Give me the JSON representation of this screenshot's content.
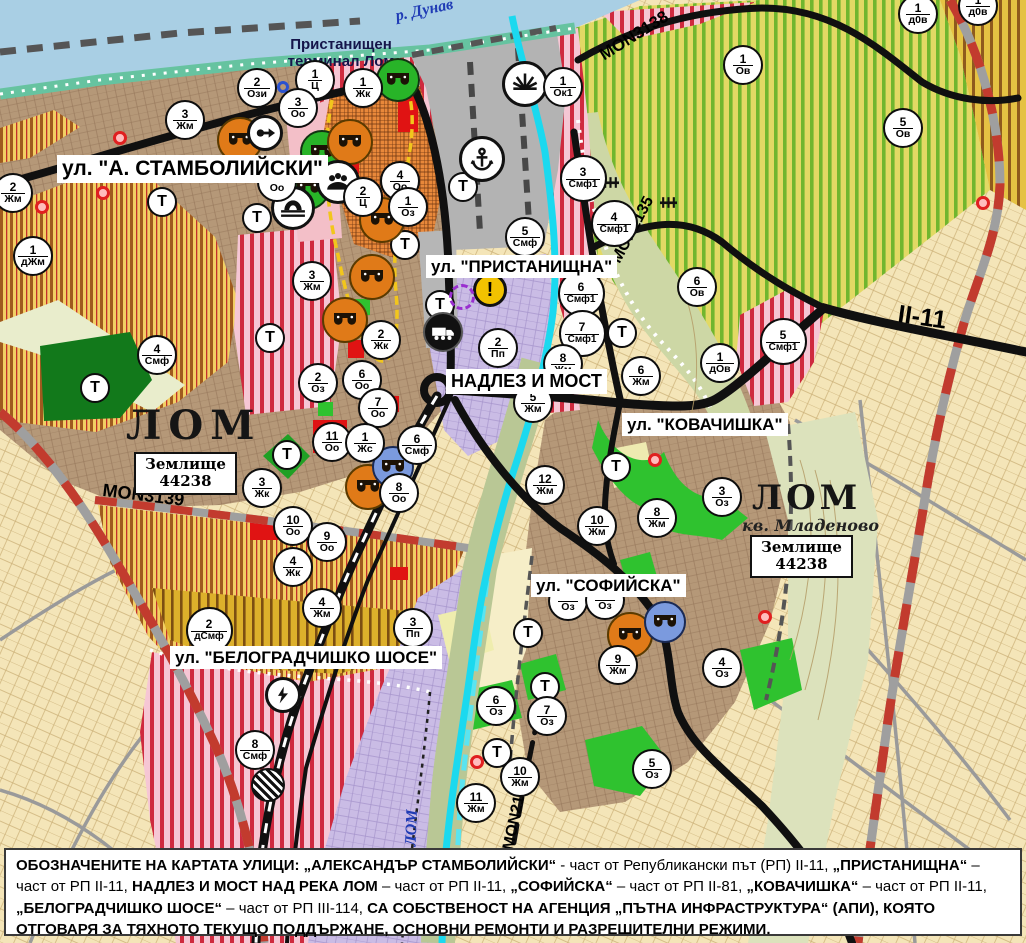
{
  "palette": {
    "water": "#a9cfe4",
    "river_lom": "#1bd9ef",
    "road_black": "#101010",
    "rail_red_dash": "#c23b2e",
    "smf_stripe": "#cf2a3e",
    "villa_stripe": "#70b62e",
    "urban_brown": "#b59878",
    "accent_orange": "#e8883a"
  },
  "water": {
    "danube_label": "р. Дунав",
    "lom_label": "р. ЛОМ"
  },
  "port": {
    "line1": "Пристанищен",
    "line2": "терминал Лом"
  },
  "places": {
    "lom_west": "ЛОМ",
    "lom_east": "ЛОМ",
    "district": "кв. Младеново"
  },
  "plots": [
    {
      "line1": "Землище",
      "line2": "44238"
    },
    {
      "line1": "Землище",
      "line2": "44238"
    }
  ],
  "streets": [
    {
      "text": "ул. \"А. СТАМБОЛИЙСКИ\"",
      "x": 57,
      "y": 155,
      "fs": 21
    },
    {
      "text": "ул. \"ПРИСТАНИЩНА\"",
      "x": 426,
      "y": 255,
      "fs": 17
    },
    {
      "text": "НАДЛЕЗ И МОСТ",
      "x": 446,
      "y": 369,
      "fs": 18
    },
    {
      "text": "ул. \"КОВАЧИШКА\"",
      "x": 622,
      "y": 413,
      "fs": 17
    },
    {
      "text": "ул. \"СОФИЙСКА\"",
      "x": 531,
      "y": 574,
      "fs": 17
    },
    {
      "text": "ул. \"БЕЛОГРАДЧИШКО ШОСЕ\"",
      "x": 170,
      "y": 646,
      "fs": 17
    }
  ],
  "road_labels": [
    {
      "text": "MON3138",
      "x": 596,
      "y": 48,
      "rot": -32,
      "fs": 17
    },
    {
      "text": "MON2135",
      "x": 608,
      "y": 258,
      "rot": -62,
      "fs": 16
    },
    {
      "text": "MON3139",
      "x": 104,
      "y": 480,
      "rot": 7,
      "fs": 18
    },
    {
      "text": "MON2136",
      "x": 500,
      "y": 848,
      "rot": -78,
      "fs": 16
    },
    {
      "text": "II-11",
      "x": 900,
      "y": 300,
      "rot": 8,
      "fs": 25
    }
  ],
  "markers": [
    {
      "n": "2",
      "z": "Ози",
      "x": 257,
      "y": 88
    },
    {
      "n": "1",
      "z": "Ц",
      "x": 315,
      "y": 80
    },
    {
      "n": "1",
      "z": "Жк",
      "x": 363,
      "y": 88
    },
    {
      "n": "3",
      "z": "Оо",
      "x": 298,
      "y": 108
    },
    {
      "n": "3",
      "z": "Жм",
      "x": 185,
      "y": 120
    },
    {
      "n": "2",
      "z": "Жм",
      "x": 13,
      "y": 193
    },
    {
      "n": "1",
      "z": "дЖм",
      "x": 33,
      "y": 256
    },
    {
      "n": "4",
      "z": "Оо",
      "x": 400,
      "y": 181
    },
    {
      "n": "4",
      "z": "Оо",
      "x": 277,
      "y": 182
    },
    {
      "n": "2",
      "z": "Ц",
      "x": 363,
      "y": 197
    },
    {
      "n": "1",
      "z": "Оз",
      "x": 408,
      "y": 207
    },
    {
      "n": "3",
      "z": "Жм",
      "x": 312,
      "y": 281
    },
    {
      "n": "2",
      "z": "Жк",
      "x": 381,
      "y": 340
    },
    {
      "n": "2",
      "z": "Оз",
      "x": 318,
      "y": 383
    },
    {
      "n": "6",
      "z": "Оо",
      "x": 362,
      "y": 380
    },
    {
      "n": "7",
      "z": "Оо",
      "x": 378,
      "y": 408
    },
    {
      "n": "5",
      "z": "Смф",
      "x": 525,
      "y": 237
    },
    {
      "n": "3",
      "z": "Смф1",
      "x": 583,
      "y": 178
    },
    {
      "n": "4",
      "z": "Смф1",
      "x": 614,
      "y": 223
    },
    {
      "n": "6",
      "z": "Смф1",
      "x": 581,
      "y": 293
    },
    {
      "n": "7",
      "z": "Смф1",
      "x": 582,
      "y": 333
    },
    {
      "n": "1",
      "z": "Ок1",
      "x": 563,
      "y": 87
    },
    {
      "n": "1",
      "z": "Ов",
      "x": 743,
      "y": 65
    },
    {
      "n": "5",
      "z": "Ов",
      "x": 903,
      "y": 128
    },
    {
      "n": "1",
      "z": "д0в",
      "x": 918,
      "y": 14
    },
    {
      "n": "1",
      "z": "д0в",
      "x": 978,
      "y": 6
    },
    {
      "n": "6",
      "z": "Ов",
      "x": 697,
      "y": 287
    },
    {
      "n": "5",
      "z": "Смф1",
      "x": 783,
      "y": 341
    },
    {
      "n": "1",
      "z": "дОв",
      "x": 720,
      "y": 363
    },
    {
      "n": "2",
      "z": "Пп",
      "x": 498,
      "y": 348
    },
    {
      "n": "8",
      "z": "Жм",
      "x": 563,
      "y": 364
    },
    {
      "n": "5",
      "z": "Жм",
      "x": 533,
      "y": 403
    },
    {
      "n": "6",
      "z": "Жм",
      "x": 641,
      "y": 376
    },
    {
      "n": "12",
      "z": "Жм",
      "x": 545,
      "y": 485
    },
    {
      "n": "8",
      "z": "Жм",
      "x": 657,
      "y": 518
    },
    {
      "n": "10",
      "z": "Жм",
      "x": 597,
      "y": 526
    },
    {
      "n": "3",
      "z": "Оз",
      "x": 722,
      "y": 497
    },
    {
      "n": "9",
      "z": "Жм",
      "x": 618,
      "y": 665
    },
    {
      "n": "4",
      "z": "Оз",
      "x": 722,
      "y": 668
    },
    {
      "n": "6",
      "z": "Оз",
      "x": 496,
      "y": 706
    },
    {
      "n": "7",
      "z": "Оз",
      "x": 547,
      "y": 716
    },
    {
      "n": "10",
      "z": "Жм",
      "x": 520,
      "y": 777
    },
    {
      "n": "11",
      "z": "Жм",
      "x": 476,
      "y": 803
    },
    {
      "n": "5",
      "z": "Оз",
      "x": 652,
      "y": 769
    },
    {
      "n": "",
      "z": "Оз",
      "x": 568,
      "y": 601
    },
    {
      "n": "",
      "z": "Оз",
      "x": 605,
      "y": 600
    },
    {
      "n": "11",
      "z": "Оо",
      "x": 332,
      "y": 442
    },
    {
      "n": "1",
      "z": "Жс",
      "x": 365,
      "y": 443
    },
    {
      "n": "6",
      "z": "Смф",
      "x": 417,
      "y": 445
    },
    {
      "n": "8",
      "z": "Оо",
      "x": 399,
      "y": 493
    },
    {
      "n": "10",
      "z": "Оо",
      "x": 293,
      "y": 526
    },
    {
      "n": "9",
      "z": "Оо",
      "x": 327,
      "y": 542
    },
    {
      "n": "4",
      "z": "Жк",
      "x": 293,
      "y": 567
    },
    {
      "n": "3",
      "z": "Жк",
      "x": 262,
      "y": 488
    },
    {
      "n": "2",
      "z": "дСмф",
      "x": 209,
      "y": 630
    },
    {
      "n": "4",
      "z": "Жм",
      "x": 322,
      "y": 608
    },
    {
      "n": "3",
      "z": "Пп",
      "x": 413,
      "y": 628
    },
    {
      "n": "8",
      "z": "Смф",
      "x": 255,
      "y": 750
    },
    {
      "n": "4",
      "z": "Смф",
      "x": 157,
      "y": 355
    }
  ],
  "t_markers": [
    [
      162,
      202
    ],
    [
      257,
      218
    ],
    [
      405,
      245
    ],
    [
      463,
      187
    ],
    [
      440,
      305
    ],
    [
      270,
      338
    ],
    [
      287,
      455
    ],
    [
      95,
      388
    ],
    [
      622,
      333
    ],
    [
      616,
      467
    ],
    [
      528,
      633
    ],
    [
      545,
      687
    ],
    [
      497,
      753
    ]
  ],
  "t_label": "Т",
  "icons": [
    {
      "t": "masks_g",
      "x": 398,
      "y": 80
    },
    {
      "t": "masks_g",
      "x": 322,
      "y": 152
    },
    {
      "t": "masks_g",
      "x": 308,
      "y": 188
    },
    {
      "t": "masks_o",
      "x": 240,
      "y": 140
    },
    {
      "t": "masks_o",
      "x": 350,
      "y": 142
    },
    {
      "t": "masks_o",
      "x": 382,
      "y": 220
    },
    {
      "t": "masks_o",
      "x": 372,
      "y": 277
    },
    {
      "t": "masks_o",
      "x": 345,
      "y": 320
    },
    {
      "t": "masks_o",
      "x": 368,
      "y": 487
    },
    {
      "t": "masks_o",
      "x": 630,
      "y": 635
    },
    {
      "t": "masks_b",
      "x": 393,
      "y": 467
    },
    {
      "t": "masks_b",
      "x": 665,
      "y": 622
    },
    {
      "t": "poi_key",
      "x": 265,
      "y": 133
    },
    {
      "t": "people",
      "x": 338,
      "y": 182
    },
    {
      "t": "bridge",
      "x": 293,
      "y": 208
    },
    {
      "t": "sun",
      "x": 525,
      "y": 84
    },
    {
      "t": "anchor",
      "x": 482,
      "y": 159
    },
    {
      "t": "truck",
      "x": 443,
      "y": 332
    },
    {
      "t": "warning",
      "x": 490,
      "y": 290
    },
    {
      "t": "dashed_circle",
      "x": 462,
      "y": 297
    },
    {
      "t": "lightning",
      "x": 283,
      "y": 695
    },
    {
      "t": "striped",
      "x": 268,
      "y": 785
    },
    {
      "t": "rail",
      "x": 610,
      "y": 180
    },
    {
      "t": "rail",
      "x": 668,
      "y": 200
    },
    {
      "t": "red_dot",
      "x": 120,
      "y": 138
    },
    {
      "t": "red_dot",
      "x": 42,
      "y": 207
    },
    {
      "t": "red_dot",
      "x": 103,
      "y": 193
    },
    {
      "t": "red_dot",
      "x": 655,
      "y": 460
    },
    {
      "t": "red_dot",
      "x": 765,
      "y": 617
    },
    {
      "t": "red_dot",
      "x": 477,
      "y": 762
    },
    {
      "t": "red_dot",
      "x": 983,
      "y": 203
    },
    {
      "t": "blue_ring",
      "x": 283,
      "y": 87
    }
  ],
  "footer": {
    "segments": [
      {
        "t": "ОБОЗНАЧЕНИТЕ НА КАРТАТА УЛИЦИ: ",
        "b": true
      },
      {
        "t": "„АЛЕКСАНДЪР СТАМБОЛИЙСКИ“",
        "b": true
      },
      {
        "t": " - част от Републикански път (РП) II-11, ",
        "b": false
      },
      {
        "t": "„ПРИСТАНИЩНА“",
        "b": true
      },
      {
        "t": " – част от РП II-11, ",
        "b": false
      },
      {
        "t": "НАДЛЕЗ И МОСТ НАД РЕКА ЛОМ",
        "b": true
      },
      {
        "t": " – част от РП II-11, ",
        "b": false
      },
      {
        "t": "„СОФИЙСКА“",
        "b": true
      },
      {
        "t": " – част от РП II-81, ",
        "b": false
      },
      {
        "t": "„КОВАЧИШКА“",
        "b": true
      },
      {
        "t": " – част от РП II-11, ",
        "b": false
      },
      {
        "t": "„БЕЛОГРАДЧИШКО ШОСЕ“",
        "b": true
      },
      {
        "t": " – част от РП III-114, ",
        "b": false
      },
      {
        "t": "СА СОБСТВЕНОСТ НА АГЕНЦИЯ „ПЪТНА ИНФРАСТРУКТУРА“ (АПИ), КОЯТО ОТГОВАРЯ ЗА ТЯХНОТО ТЕКУЩО ПОДДЪРЖАНЕ, ОСНОВНИ РЕМОНТИ И РАЗРЕШИТЕЛНИ РЕЖИМИ.",
        "b": true
      }
    ]
  }
}
